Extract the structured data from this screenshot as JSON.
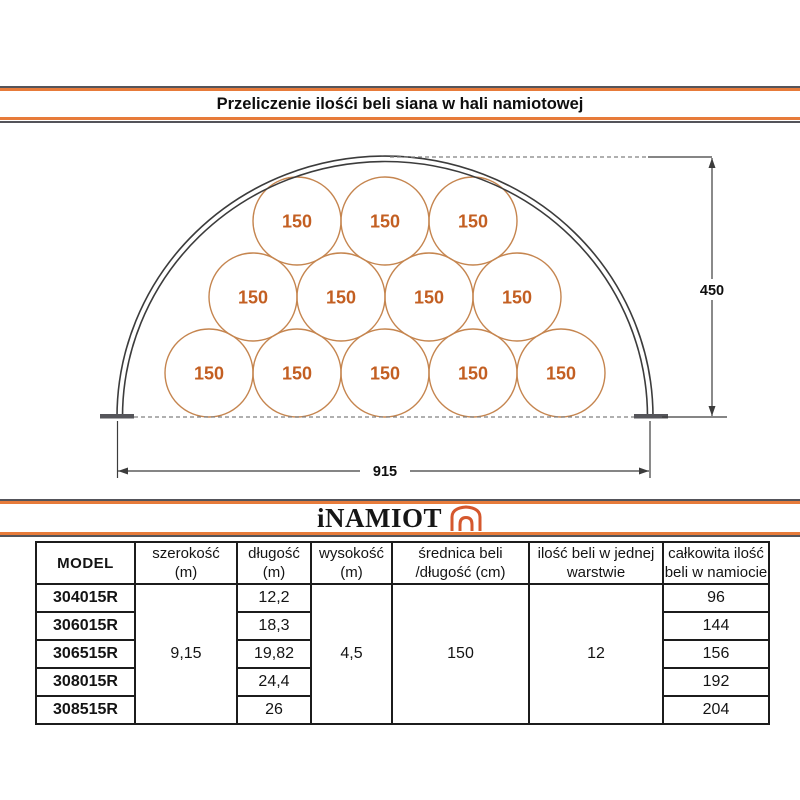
{
  "title": "Przeliczenie ilośći beli siana w hali namiotowej",
  "logo": {
    "text": "iNAMIOT",
    "icon": "tent-arch-icon"
  },
  "diagram": {
    "bale_label": "150",
    "bale_count": 12,
    "height_dimension": "450",
    "width_dimension": "915",
    "bale_radius": 44,
    "bale_rows": [
      {
        "y": 373,
        "centers": [
          209,
          297,
          385,
          473,
          561
        ]
      },
      {
        "y": 297,
        "centers": [
          253,
          341,
          429,
          517
        ]
      },
      {
        "y": 221,
        "centers": [
          297,
          385,
          473
        ]
      }
    ]
  },
  "colors": {
    "accent_orange": "#e77b3a",
    "rule_gray": "#54545a",
    "bale_stroke": "#c5854f",
    "bale_text": "#c35f22",
    "logo_icon_orange": "#d5582e",
    "line_dark": "#3c3c3c",
    "dash_gray": "#808080"
  },
  "table": {
    "headers": [
      {
        "line1": "MODEL",
        "line2": ""
      },
      {
        "line1": "szerokość",
        "line2": "(m)"
      },
      {
        "line1": "długość",
        "line2": "(m)"
      },
      {
        "line1": "wysokość",
        "line2": "(m)"
      },
      {
        "line1": "średnica beli",
        "line2": "/długość (cm)"
      },
      {
        "line1": "ilość beli w jednej",
        "line2": "warstwie"
      },
      {
        "line1": "całkowita ilość",
        "line2": "beli w namiocie"
      }
    ],
    "merged": {
      "szerokosc_m": "9,15",
      "wysokosc_m": "4,5",
      "srednica_cm": "150",
      "ilosc_w_warstwie": "12"
    },
    "rows": [
      {
        "model": "304015R",
        "dlugosc_m": "12,2",
        "total": "96"
      },
      {
        "model": "306015R",
        "dlugosc_m": "18,3",
        "total": "144"
      },
      {
        "model": "306515R",
        "dlugosc_m": "19,82",
        "total": "156"
      },
      {
        "model": "308015R",
        "dlugosc_m": "24,4",
        "total": "192"
      },
      {
        "model": "308515R",
        "dlugosc_m": "26",
        "total": "204"
      }
    ]
  }
}
